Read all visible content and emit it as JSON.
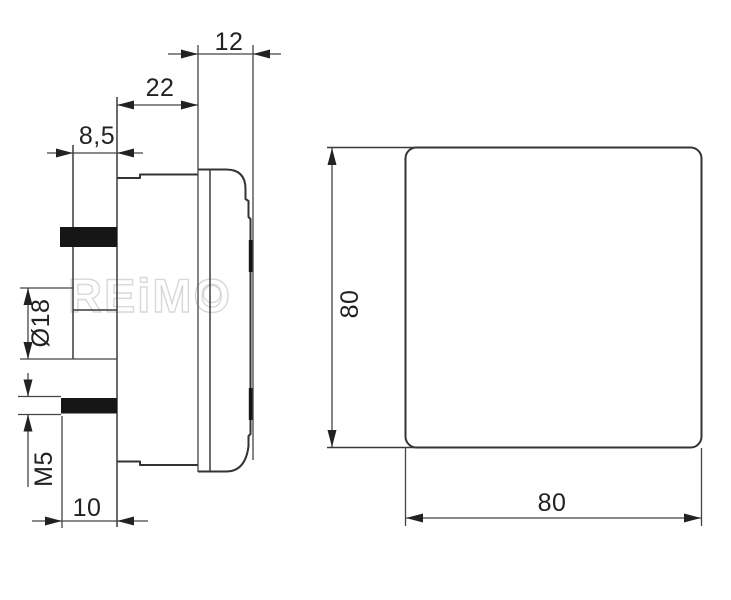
{
  "watermark": {
    "text": "REiMO"
  },
  "side_view": {
    "dims": {
      "bezel_depth": "12",
      "body_depth": "22",
      "rear_tube_length": "8,5",
      "tube_diameter": "Ø18",
      "stud_thread": "M5",
      "stud_length": "10"
    }
  },
  "front_view": {
    "dims": {
      "height": "80",
      "width": "80"
    }
  },
  "colors": {
    "line": "#333333",
    "dimension_line": "#444444",
    "text": "#222222",
    "solid_fill": "#161616",
    "watermark": "#d8d8d8",
    "background": "#ffffff"
  }
}
